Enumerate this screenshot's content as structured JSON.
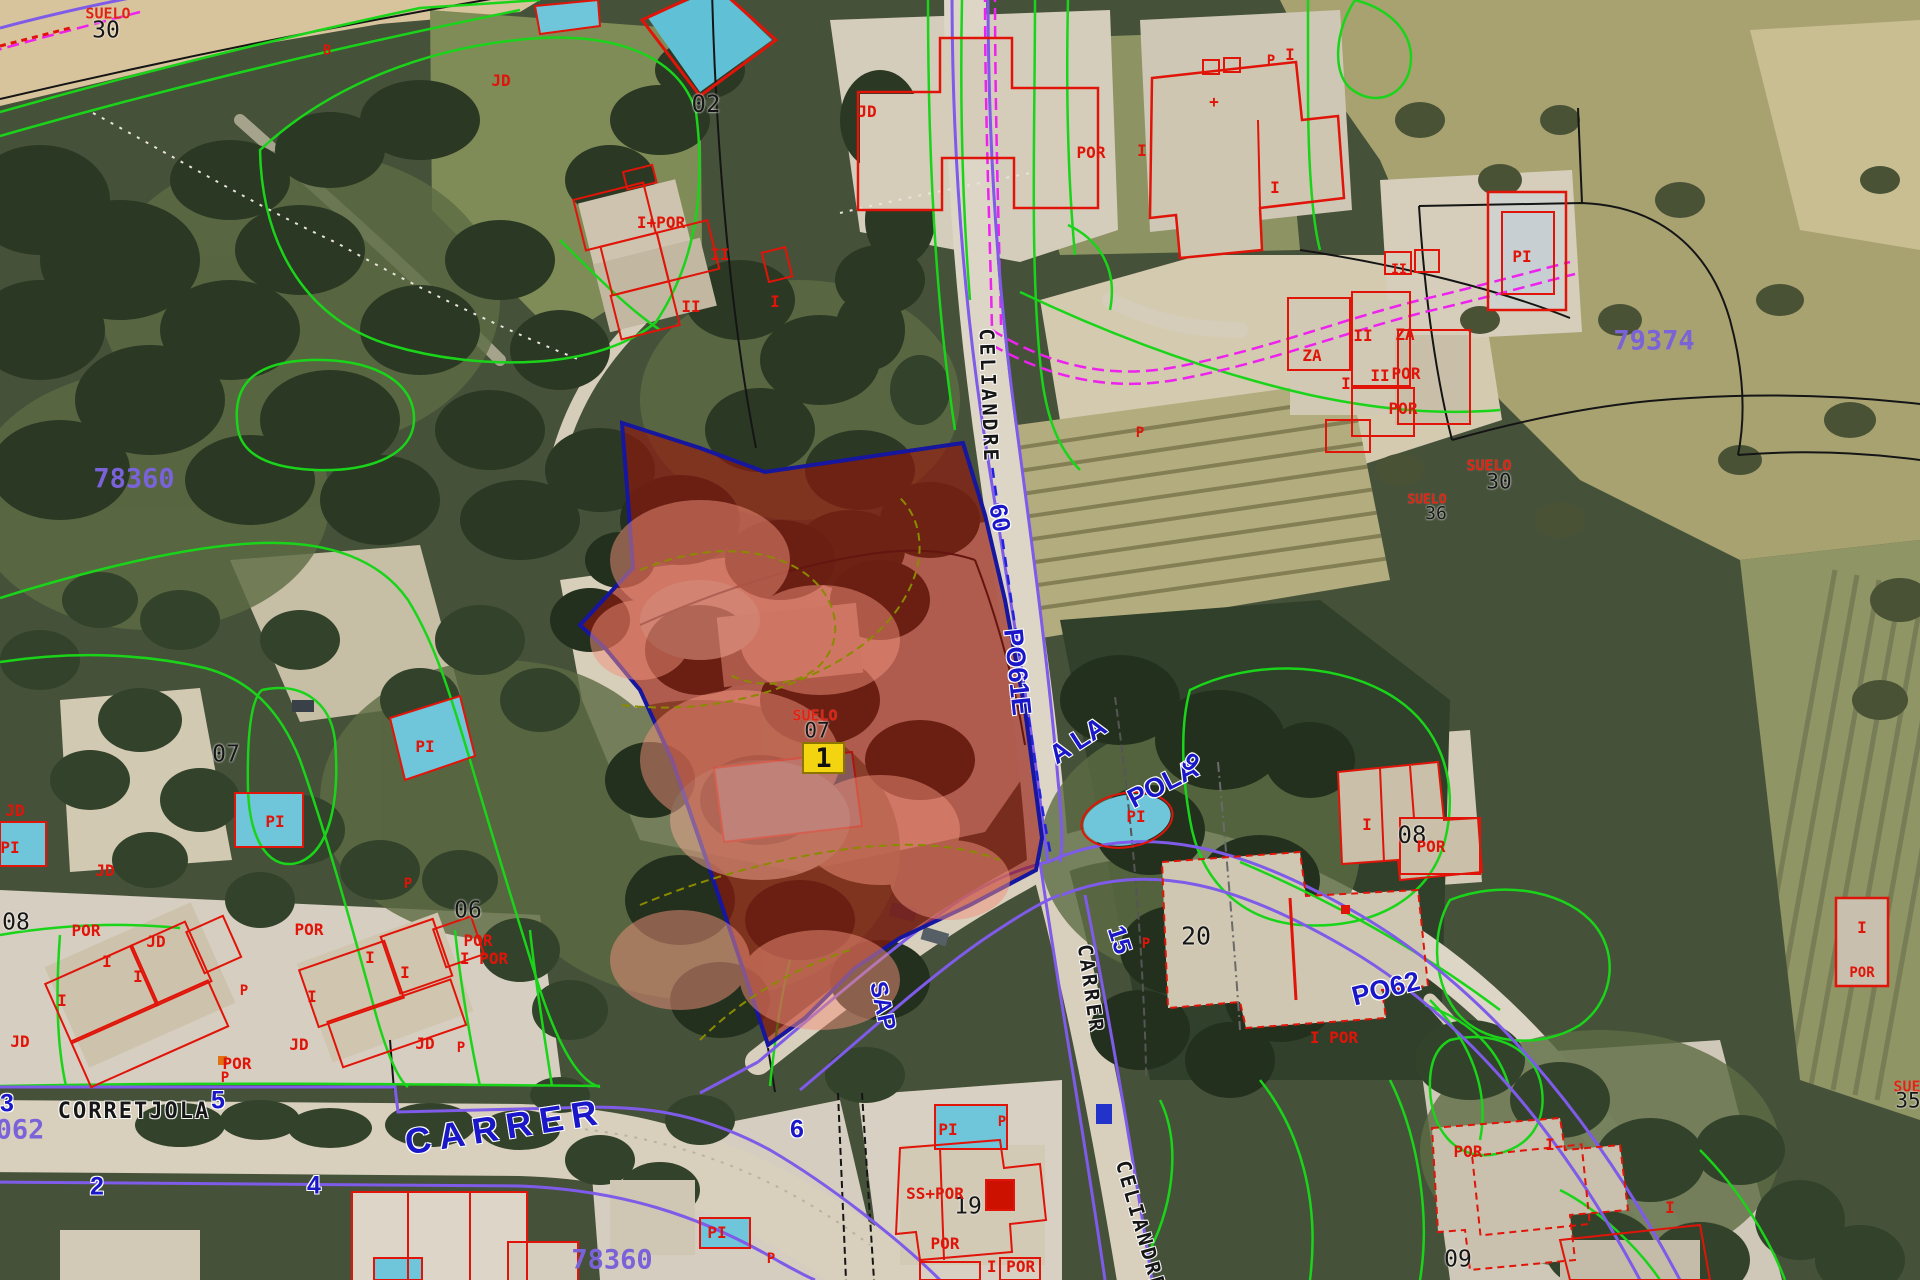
{
  "map": {
    "type": "cadastral-aerial-view",
    "selected_parcel": {
      "marker_number": "1",
      "land_use_label": "SUELO",
      "parcel_number": "07",
      "fill_color": "#96150c",
      "border_color": "#16169e",
      "marker_color": "#f2d411"
    },
    "colors": {
      "parcel_boundary_green": "#1ad41a",
      "road_line_purple": "#7e5be8",
      "road_line_magenta": "#ee22ee",
      "building_outline_red": "#e01408",
      "street_text_blue": "#1a17c8",
      "block_number_purple": "#7a62d8"
    },
    "label_groups": [
      {
        "name": "block-number",
        "cls": "lbl-block",
        "color": "#7a62d8",
        "font": "mono",
        "size": 27,
        "weight": 700,
        "items": [
          {
            "text": "78360",
            "x": 134,
            "y": 479
          },
          {
            "text": "79374",
            "x": 1654,
            "y": 341
          },
          {
            "text": "78360",
            "x": 612,
            "y": 1260
          },
          {
            "text": "062",
            "x": 20,
            "y": 1130
          }
        ]
      },
      {
        "name": "street-name-blue",
        "cls": "lbl-street-blue",
        "color": "#1a17c8",
        "font": "sans",
        "size": 27,
        "weight": 700,
        "items": [
          {
            "text": "CARRER",
            "x": 505,
            "y": 1127,
            "rot": -9,
            "size": 36,
            "spacing": 8
          },
          {
            "text": "PO61E",
            "x": 1017,
            "y": 672,
            "rot": 84
          },
          {
            "text": "A LA",
            "x": 1078,
            "y": 741,
            "rot": -33
          },
          {
            "text": "POLA",
            "x": 1163,
            "y": 784,
            "rot": -27
          },
          {
            "text": "PO62",
            "x": 1386,
            "y": 989,
            "rot": -14
          },
          {
            "text": "SAP",
            "x": 882,
            "y": 1006,
            "rot": 78,
            "size": 24
          }
        ]
      },
      {
        "name": "house-number-blue",
        "cls": "lbl-number-blue",
        "color": "#1a17c8",
        "font": "sans",
        "size": 25,
        "weight": 700,
        "items": [
          {
            "text": "2",
            "x": 97,
            "y": 1187
          },
          {
            "text": "4",
            "x": 314,
            "y": 1186
          },
          {
            "text": "5",
            "x": 218,
            "y": 1101
          },
          {
            "text": "3",
            "x": 7,
            "y": 1104
          },
          {
            "text": "6",
            "x": 797,
            "y": 1130
          },
          {
            "text": "60",
            "x": 999,
            "y": 518,
            "rot": 80
          },
          {
            "text": "9",
            "x": 1190,
            "y": 763,
            "rot": 40
          },
          {
            "text": "15",
            "x": 1119,
            "y": 940,
            "rot": 72
          }
        ]
      },
      {
        "name": "street-name-black",
        "cls": "lbl-street-black",
        "color": "#161616",
        "font": "mono",
        "size": 22,
        "weight": 700,
        "items": [
          {
            "text": "CORRETJOLA",
            "x": 134,
            "y": 1112,
            "spacing": 2
          },
          {
            "text": "CELIANDRE",
            "x": 989,
            "y": 396,
            "rot": 88,
            "spacing": 3,
            "size": 20
          },
          {
            "text": "CELIANDRE",
            "x": 1141,
            "y": 1226,
            "rot": 74,
            "spacing": 3,
            "size": 20
          },
          {
            "text": "CARRER",
            "x": 1091,
            "y": 989,
            "rot": 82,
            "spacing": 3,
            "size": 20
          }
        ]
      },
      {
        "name": "land-use-label",
        "cls": "lbl-red",
        "color": "#e02313",
        "font": "mono",
        "size": 15,
        "weight": 700,
        "items": [
          {
            "text": "SUELO",
            "x": 108,
            "y": 14
          },
          {
            "text": "SUELO",
            "x": 1489,
            "y": 466
          },
          {
            "text": "SUELO",
            "x": 1427,
            "y": 500,
            "size": 13
          },
          {
            "text": "SUELO",
            "x": 815,
            "y": 716
          },
          {
            "text": "SUELO",
            "x": 1916,
            "y": 1087
          }
        ]
      },
      {
        "name": "parcel-number",
        "cls": "lbl-parcel-num",
        "color": "#161616",
        "font": "mono",
        "size": 21,
        "weight": 400,
        "items": [
          {
            "text": "30",
            "x": 106,
            "y": 31,
            "size": 23
          },
          {
            "text": "30",
            "x": 1499,
            "y": 482
          },
          {
            "text": "36",
            "x": 1436,
            "y": 514,
            "size": 18
          },
          {
            "text": "07",
            "x": 817,
            "y": 731
          },
          {
            "text": "35",
            "x": 1908,
            "y": 1101
          },
          {
            "text": "02",
            "x": 706,
            "y": 104,
            "size": 24
          },
          {
            "text": "07",
            "x": 226,
            "y": 755,
            "size": 23
          },
          {
            "text": "08",
            "x": 16,
            "y": 923,
            "size": 23
          },
          {
            "text": "06",
            "x": 468,
            "y": 911,
            "size": 23
          },
          {
            "text": "20",
            "x": 1196,
            "y": 936,
            "size": 25
          },
          {
            "text": "08",
            "x": 1412,
            "y": 835,
            "size": 24
          },
          {
            "text": "19",
            "x": 968,
            "y": 1207,
            "size": 23
          },
          {
            "text": "09",
            "x": 1458,
            "y": 1260,
            "size": 23
          }
        ]
      },
      {
        "name": "building-annotation",
        "cls": "lbl-bldg",
        "color": "#e01408",
        "font": "mono",
        "size": 16,
        "weight": 700,
        "items": [
          {
            "text": "JD",
            "x": 501,
            "y": 81
          },
          {
            "text": "B",
            "x": 327,
            "y": 51,
            "size": 13
          },
          {
            "text": "JD",
            "x": 867,
            "y": 112
          },
          {
            "text": "P",
            "x": 1271,
            "y": 61,
            "size": 14
          },
          {
            "text": "I+POR",
            "x": 661,
            "y": 223
          },
          {
            "text": "II",
            "x": 720,
            "y": 255
          },
          {
            "text": "II",
            "x": 691,
            "y": 307
          },
          {
            "text": "I",
            "x": 775,
            "y": 302
          },
          {
            "text": "POR",
            "x": 1091,
            "y": 153
          },
          {
            "text": "I",
            "x": 1142,
            "y": 151
          },
          {
            "text": "I",
            "x": 1290,
            "y": 55
          },
          {
            "text": "+",
            "x": 1214,
            "y": 102
          },
          {
            "text": "I",
            "x": 1275,
            "y": 188
          },
          {
            "text": "ZA",
            "x": 1312,
            "y": 356
          },
          {
            "text": "II",
            "x": 1363,
            "y": 336
          },
          {
            "text": "ZA",
            "x": 1405,
            "y": 335
          },
          {
            "text": "I",
            "x": 1346,
            "y": 384
          },
          {
            "text": "II",
            "x": 1380,
            "y": 376
          },
          {
            "text": "POR",
            "x": 1406,
            "y": 374
          },
          {
            "text": "POR",
            "x": 1403,
            "y": 409
          },
          {
            "text": "P",
            "x": 1140,
            "y": 433,
            "size": 14
          },
          {
            "text": "II",
            "x": 1399,
            "y": 270,
            "size": 13
          },
          {
            "text": "PI",
            "x": 1522,
            "y": 257
          },
          {
            "text": "PI",
            "x": 425,
            "y": 747
          },
          {
            "text": "PI",
            "x": 275,
            "y": 822
          },
          {
            "text": "PI",
            "x": 10,
            "y": 848
          },
          {
            "text": "JD",
            "x": 15,
            "y": 811
          },
          {
            "text": "JD",
            "x": 105,
            "y": 871
          },
          {
            "text": "JD",
            "x": 156,
            "y": 942
          },
          {
            "text": "POR",
            "x": 86,
            "y": 931
          },
          {
            "text": "I",
            "x": 107,
            "y": 962
          },
          {
            "text": "I",
            "x": 138,
            "y": 977
          },
          {
            "text": "I",
            "x": 62,
            "y": 1001
          },
          {
            "text": "JD",
            "x": 20,
            "y": 1042
          },
          {
            "text": "P",
            "x": 244,
            "y": 991,
            "size": 14
          },
          {
            "text": "POR",
            "x": 309,
            "y": 930
          },
          {
            "text": "I",
            "x": 370,
            "y": 958
          },
          {
            "text": "I",
            "x": 405,
            "y": 973
          },
          {
            "text": "I",
            "x": 312,
            "y": 997
          },
          {
            "text": "JD",
            "x": 299,
            "y": 1045
          },
          {
            "text": "JD",
            "x": 425,
            "y": 1044
          },
          {
            "text": "P",
            "x": 461,
            "y": 1048,
            "size": 14
          },
          {
            "text": "P",
            "x": 408,
            "y": 884,
            "size": 14
          },
          {
            "text": "POR",
            "x": 478,
            "y": 941
          },
          {
            "text": "I POR",
            "x": 484,
            "y": 959
          },
          {
            "text": "POR",
            "x": 237,
            "y": 1064
          },
          {
            "text": "P",
            "x": 225,
            "y": 1078,
            "size": 14
          },
          {
            "text": "PI",
            "x": 717,
            "y": 1233
          },
          {
            "text": "P",
            "x": 771,
            "y": 1259,
            "size": 14
          },
          {
            "text": "PI",
            "x": 948,
            "y": 1130
          },
          {
            "text": "P",
            "x": 1002,
            "y": 1122,
            "size": 14
          },
          {
            "text": "SS+POR",
            "x": 935,
            "y": 1194
          },
          {
            "text": "POR",
            "x": 945,
            "y": 1244
          },
          {
            "text": "I POR",
            "x": 1011,
            "y": 1267
          },
          {
            "text": "POR",
            "x": 1468,
            "y": 1152
          },
          {
            "text": "I",
            "x": 1550,
            "y": 1145
          },
          {
            "text": "I",
            "x": 1670,
            "y": 1208
          },
          {
            "text": "I",
            "x": 1367,
            "y": 825
          },
          {
            "text": "POR",
            "x": 1431,
            "y": 847
          },
          {
            "text": "I POR",
            "x": 1334,
            "y": 1038
          },
          {
            "text": "PI",
            "x": 1136,
            "y": 817
          },
          {
            "text": "P",
            "x": 1146,
            "y": 944,
            "size": 14
          },
          {
            "text": "I",
            "x": 1862,
            "y": 928
          },
          {
            "text": "POR",
            "x": 1862,
            "y": 973,
            "size": 14
          }
        ]
      }
    ]
  }
}
